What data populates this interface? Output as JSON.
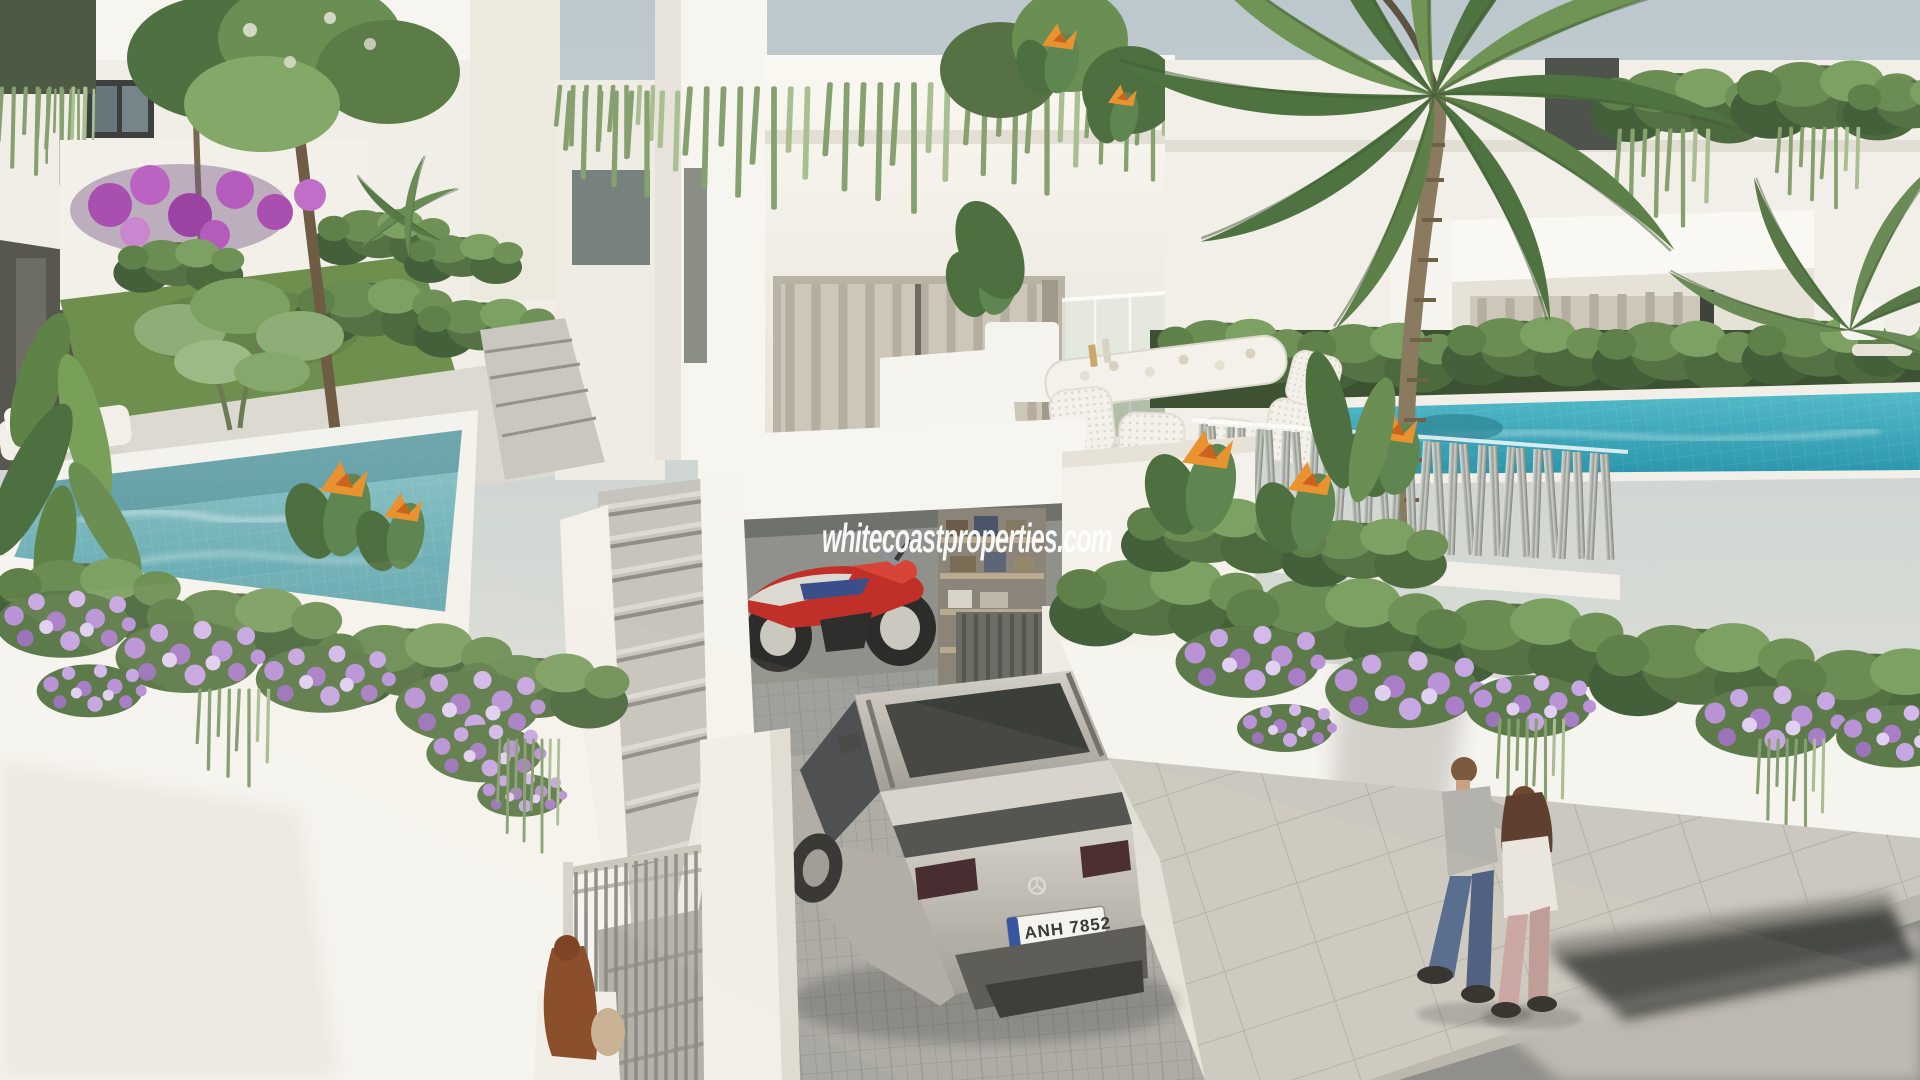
{
  "scene": {
    "watermark": "whitecoastproperties.com",
    "license_plate": "ANH 7852",
    "elements": [
      "modern white villas with roof gardens",
      "private turquoise pools",
      "large palm tree",
      "silver suv on driveway",
      "red sport motorcycle in open garage",
      "outdoor dining set with white wicker chairs",
      "metallic slatted privacy fence",
      "white walls with cascading purple flowers",
      "bird of paradise plants",
      "couple walking on sidewalk",
      "woman with red hair at gate",
      "motion-blurred car on road"
    ]
  },
  "palette": {
    "sky": "#c3ccd1",
    "villa_white": "#f4f1ea",
    "pool_teal_left": "#79b7bd",
    "pool_teal_right": "#35a7ba",
    "foliage_green": "#5c7d45",
    "flower_purple": "#b48cd1",
    "bougainvillea_magenta": "#a85ab0",
    "bird_of_paradise_orange": "#e8932f",
    "car_silver": "#b6b3ab",
    "motorcycle_red": "#c23b30",
    "fence_metal": "#b9bdb7",
    "paver_gray": "#a5a49e",
    "road_asphalt": "#8b8a86"
  }
}
